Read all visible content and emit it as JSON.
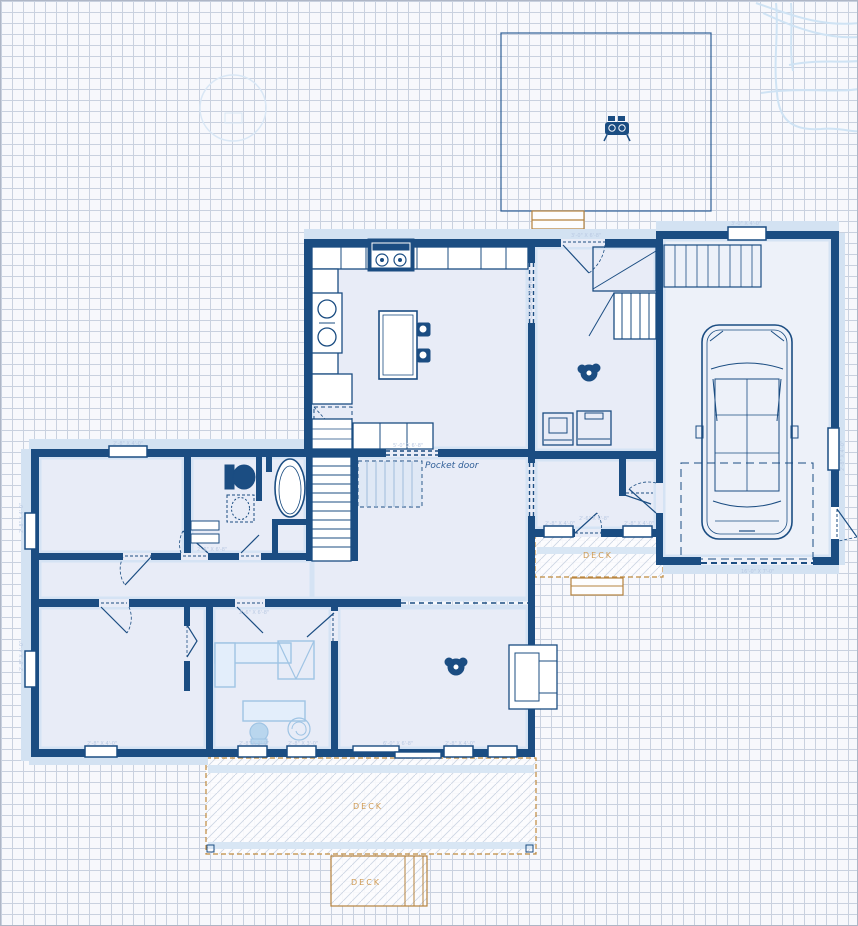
{
  "app": {
    "view": "floor-plan-canvas"
  },
  "colors": {
    "wall": "#1b4d82",
    "room_fill": "#e8ecf7",
    "room_inner_edge": "#d5e3f4",
    "walkway": "#d3e2f2",
    "garage_fill": "#edf1f9",
    "deck_border": "#c08a3e",
    "deck_label": "#cf9a52",
    "deck_hatch": "#cdd5e3",
    "grid_line": "#c9d1df",
    "paper": "#f7f8fc",
    "faint_dim_text": "#b9c9e2",
    "light_furniture": "#9fc4e4",
    "contour_line": "#cfe3f4"
  },
  "labels": {
    "deck_right": "DECK",
    "deck_main": "DECK",
    "deck_small": "DECK",
    "pocket_door": "Pocket door"
  },
  "dims": [
    {
      "text": "2'-8\" X 4'-0\""
    },
    {
      "text": "2'-8\" X 4'-0\""
    },
    {
      "text": "2'-8\" X 4'-0\""
    },
    {
      "text": "2'-8\" X 4'-0\""
    },
    {
      "text": "2'-8\" X 3'-0\""
    },
    {
      "text": "2'-8\" X 3'-0\""
    },
    {
      "text": "6'-0\" X 6'-8\""
    },
    {
      "text": "2'-8\" X 4'-0\""
    },
    {
      "text": "3'-0\" X 6'-8\""
    },
    {
      "text": "3'-0\" X 4'-0\""
    },
    {
      "text": "16'-0\" X 7'-0\""
    },
    {
      "text": "2'-6\" X 6'-8\""
    },
    {
      "text": "2'-6\" X 6'-8\""
    },
    {
      "text": "5'-0\" X 6'-8\""
    },
    {
      "text": "CASED OPENING"
    },
    {
      "text": "2'-8\" X 4'-0\""
    },
    {
      "text": "2'-8\" X 4'-0\""
    },
    {
      "text": "2'-8\" X 4'-0\""
    },
    {
      "text": "2'-6\" X 6'-8\""
    }
  ]
}
